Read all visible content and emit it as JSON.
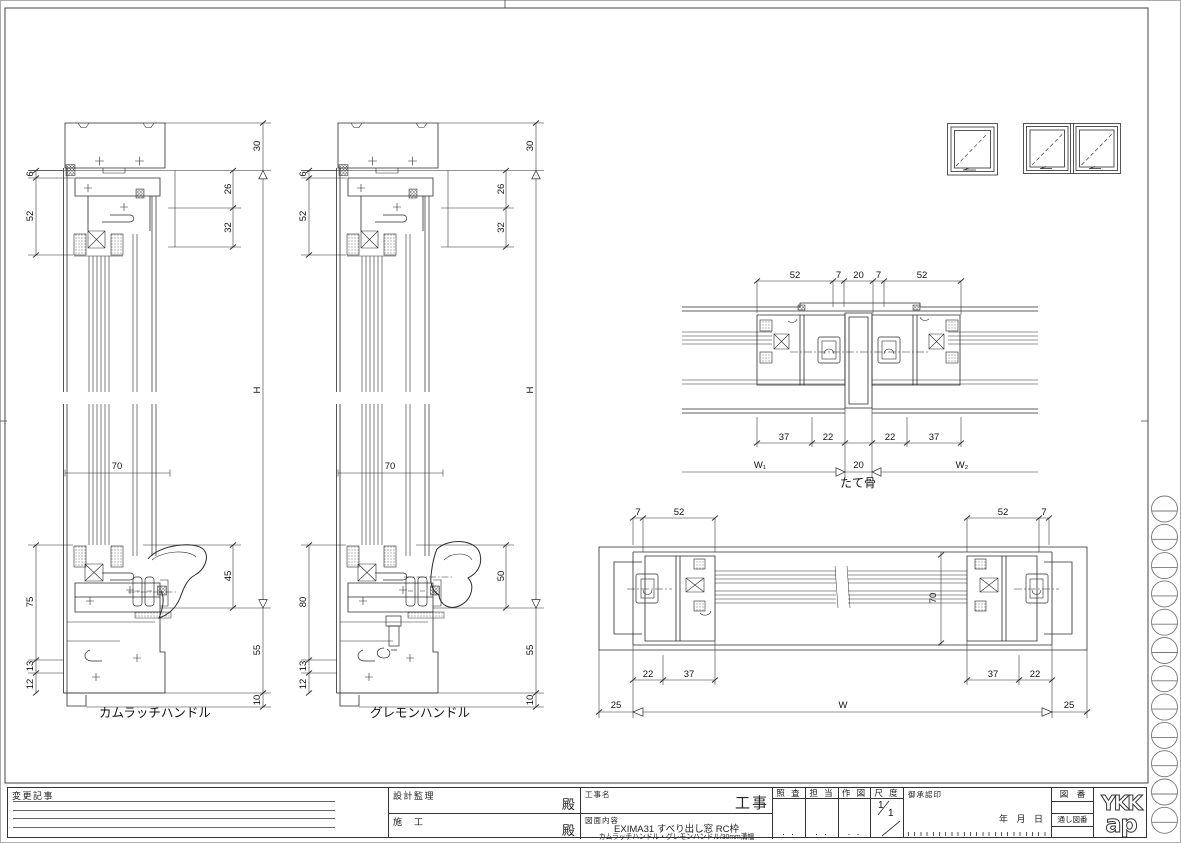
{
  "sheet": {
    "bg": "#ffffff",
    "line_color": "#2b2b2b",
    "frame_color": "#444444"
  },
  "dims": {
    "s1": {
      "label": "カムラッチハンドル",
      "d6": "6",
      "d52": "52",
      "d75": "75",
      "d13": "13",
      "d12": "12",
      "d30": "30",
      "d26": "26",
      "d32": "32",
      "dH": "H",
      "d45": "45",
      "d55": "55",
      "d10": "10",
      "d70": "70"
    },
    "s2": {
      "label": "グレモンハンドル",
      "d6": "6",
      "d52": "52",
      "d80": "80",
      "d13": "13",
      "d12": "12",
      "d30": "30",
      "d26": "26",
      "d32": "32",
      "dH": "H",
      "d50": "50",
      "d55": "55",
      "d10": "10",
      "d70": "70"
    },
    "mullion": {
      "label": "たて骨",
      "t52l": "52",
      "t7l": "7",
      "t20": "20",
      "t7r": "7",
      "t52r": "52",
      "b37l": "37",
      "b22l": "22",
      "b22r": "22",
      "b37r": "37",
      "w1": "W₁",
      "w20": "20",
      "w2": "W₂"
    },
    "plan": {
      "t7l": "7",
      "t52l": "52",
      "t52r": "52",
      "t7r": "7",
      "d70": "70",
      "b22l": "22",
      "b37l": "37",
      "b37r": "37",
      "b22r": "22",
      "p25l": "25",
      "w": "W",
      "p25r": "25"
    }
  },
  "titleblock": {
    "change": "変更記事",
    "design": "設計監理",
    "dono1": "殿",
    "construction": "施　工",
    "dono2": "殿",
    "project": "工事名",
    "project_big": "工事",
    "content": "図面内容",
    "content1": "EXIMA31 すべり出し窓 RC枠",
    "content2": "カムラッチハンドル・グレモンハンドル/30mm溝幅",
    "check": "照 査",
    "charge": "担 当",
    "draft": "作 図",
    "scale": "尺 度",
    "scale_num": "1",
    "scale_den": "1",
    "approval": "御承認印",
    "date": "年 月 日",
    "fig": "図　番",
    "serial": "通し図番",
    "dots": ". .",
    "logo1": "YKK",
    "logo2": "ap"
  }
}
